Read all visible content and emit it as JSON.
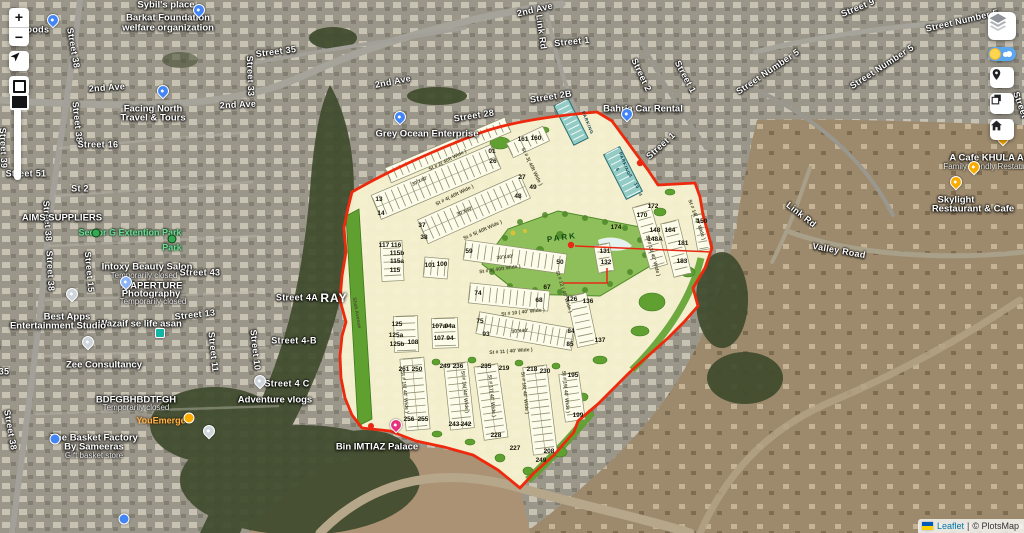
{
  "attribution": {
    "link": "Leaflet",
    "rest": "© PlotsMap",
    "separator": "|"
  },
  "controls": {
    "zoom_in": "+",
    "zoom_out": "−",
    "left": [
      "zoom-in",
      "zoom-out",
      "locate",
      "draw-rectangle",
      "zoom-slider"
    ],
    "right": [
      "layers",
      "day-night-toggle",
      "marker",
      "copy-layers",
      "home"
    ]
  },
  "colors": {
    "plan_fill": "#f6f2d0",
    "plan_boundary": "#ee2a0e",
    "plan_green": "#5fa030",
    "commercial_teal": "#93ccc5",
    "toggle_blue": "#5aa7f0",
    "pin_blue": "#4285F4",
    "pin_orange": "#f9ab00",
    "pin_magenta": "#e5327f",
    "link_blue": "#0078A8"
  },
  "map_labels": [
    {
      "t": "Foods",
      "x": 35,
      "y": 30
    },
    {
      "t": "Sybil's place",
      "x": 166,
      "y": 5,
      "c": "poi"
    },
    {
      "t": "Barkat Foundation",
      "x": 168,
      "y": 18,
      "c": "poi"
    },
    {
      "t": "welfare organization",
      "x": 168,
      "y": 28,
      "c": "poi"
    },
    {
      "t": "2nd Ave",
      "x": 107,
      "y": 88,
      "r": -4
    },
    {
      "t": "2nd Ave",
      "x": 238,
      "y": 105,
      "r": -3
    },
    {
      "t": "2nd Ave",
      "x": 393,
      "y": 82,
      "r": -11
    },
    {
      "t": "2nd Ave",
      "x": 535,
      "y": 10,
      "r": -13
    },
    {
      "t": "Street 38",
      "x": 73,
      "y": 48,
      "r": 80
    },
    {
      "t": "Street 38",
      "x": 77,
      "y": 122,
      "r": 84
    },
    {
      "t": "Street 38",
      "x": 47,
      "y": 221,
      "r": 86
    },
    {
      "t": "Street 38",
      "x": 50,
      "y": 271,
      "r": 87
    },
    {
      "t": "Street 38",
      "x": 10,
      "y": 430,
      "r": 80
    },
    {
      "t": "Street 39",
      "x": 3,
      "y": 148,
      "r": 88
    },
    {
      "t": "Street 35",
      "x": 276,
      "y": 52,
      "r": -7
    },
    {
      "t": "Street 33",
      "x": 250,
      "y": 76,
      "r": 88
    },
    {
      "t": "Street 16",
      "x": 98,
      "y": 145
    },
    {
      "t": "Street 51",
      "x": 26,
      "y": 174
    },
    {
      "t": "St 2",
      "x": 80,
      "y": 189
    },
    {
      "t": "Facing North",
      "x": 153,
      "y": 109,
      "c": "poi"
    },
    {
      "t": "Travel & Tours",
      "x": 153,
      "y": 118,
      "c": "poi"
    },
    {
      "t": "AIMS SUPPLIERS",
      "x": 62,
      "y": 218,
      "c": "poi"
    },
    {
      "t": "Sector G Extention Park",
      "x": 130,
      "y": 233,
      "c": "grn"
    },
    {
      "t": "Park",
      "x": 172,
      "y": 248,
      "c": "grn"
    },
    {
      "t": "Intoxy Beauty Salon",
      "x": 147,
      "y": 267,
      "c": "poi"
    },
    {
      "t": "Temporarily closed",
      "x": 144,
      "y": 276,
      "c": "sub"
    },
    {
      "t": "Street 43",
      "x": 200,
      "y": 273
    },
    {
      "t": "X APERTURE",
      "x": 152,
      "y": 286,
      "c": "poi"
    },
    {
      "t": "Photography",
      "x": 151,
      "y": 294,
      "c": "poi"
    },
    {
      "t": "Temporarily closed",
      "x": 153,
      "y": 302,
      "c": "sub"
    },
    {
      "t": "Street 13",
      "x": 195,
      "y": 315,
      "r": -6
    },
    {
      "t": "Street 15",
      "x": 89,
      "y": 272,
      "r": 85
    },
    {
      "t": "Wazaif se life asan",
      "x": 140,
      "y": 324,
      "c": "poi"
    },
    {
      "t": "Best Apps",
      "x": 67,
      "y": 317,
      "c": "poi"
    },
    {
      "t": "Entertainment Studio",
      "x": 58,
      "y": 326,
      "c": "poi"
    },
    {
      "t": "Street 36",
      "x": -6,
      "y": 330,
      "r": 84
    },
    {
      "t": "35",
      "x": 4,
      "y": 372
    },
    {
      "t": "Zee Consultancy",
      "x": 104,
      "y": 365,
      "c": "poi"
    },
    {
      "t": "BDFGBHBDTFGH",
      "x": 136,
      "y": 400,
      "c": "poi"
    },
    {
      "t": "Temporarily closed",
      "x": 136,
      "y": 408,
      "c": "sub"
    },
    {
      "t": "YouEmerge",
      "x": 161,
      "y": 421,
      "c": "org"
    },
    {
      "t": "The Basket Factory",
      "x": 94,
      "y": 438,
      "c": "poi"
    },
    {
      "t": "By Sameeras",
      "x": 94,
      "y": 447,
      "c": "poi"
    },
    {
      "t": "Gift basket store",
      "x": 94,
      "y": 456,
      "c": "sub"
    },
    {
      "t": "Adventure vlogs",
      "x": 275,
      "y": 400,
      "c": "poi"
    },
    {
      "t": "Street 4 C",
      "x": 287,
      "y": 384
    },
    {
      "t": "Street 4A",
      "x": 297,
      "y": 298
    },
    {
      "t": "Street 4-B",
      "x": 294,
      "y": 341
    },
    {
      "t": "Street 10",
      "x": 255,
      "y": 350,
      "r": 84
    },
    {
      "t": "Street 11",
      "x": 213,
      "y": 352,
      "r": 84
    },
    {
      "t": "RAY",
      "x": 334,
      "y": 298,
      "c": "big"
    },
    {
      "t": "Bin IMTIAZ Palace",
      "x": 377,
      "y": 447,
      "c": "poi"
    },
    {
      "t": "Grey Ocean Enterprise",
      "x": 427,
      "y": 134,
      "c": "poi"
    },
    {
      "t": "Street 28",
      "x": 474,
      "y": 116,
      "r": -9
    },
    {
      "t": "Street 2B",
      "x": 551,
      "y": 97,
      "r": -9
    },
    {
      "t": "Street 1",
      "x": 572,
      "y": 42,
      "r": -6
    },
    {
      "t": "Link Rd",
      "x": 541,
      "y": 32,
      "r": 82
    },
    {
      "t": "Street 2",
      "x": 641,
      "y": 75,
      "r": 65
    },
    {
      "t": "Street 1",
      "x": 685,
      "y": 77,
      "r": 62
    },
    {
      "t": "Street 1",
      "x": 661,
      "y": 146,
      "r": -42
    },
    {
      "t": "Bahria Car Rental",
      "x": 643,
      "y": 109,
      "c": "poi"
    },
    {
      "t": "Street 9",
      "x": 858,
      "y": 8,
      "r": -22
    },
    {
      "t": "Street Number 5",
      "x": 962,
      "y": 21,
      "r": -13
    },
    {
      "t": "Street Number 5",
      "x": 882,
      "y": 67,
      "r": -33
    },
    {
      "t": "Street Number 5",
      "x": 768,
      "y": 72,
      "r": -34
    },
    {
      "t": "Street",
      "x": 1020,
      "y": 105,
      "r": 70
    },
    {
      "t": "Link Rd",
      "x": 801,
      "y": 215,
      "r": 38
    },
    {
      "t": "Valley Road",
      "x": 839,
      "y": 251,
      "r": 10
    },
    {
      "t": "A Cafe KHULA AA",
      "x": 990,
      "y": 158,
      "c": "poi"
    },
    {
      "t": "Family-friendly Restaurant",
      "x": 990,
      "y": 167,
      "c": "sub"
    },
    {
      "t": "Skylight",
      "x": 956,
      "y": 200,
      "c": "poi"
    },
    {
      "t": "Restaurant & Cafe",
      "x": 973,
      "y": 209,
      "c": "poi"
    }
  ],
  "overlay": {
    "texts": [
      {
        "t": "St # 2( 40ft Wide )",
        "x": 448,
        "y": 161,
        "r": -27
      },
      {
        "t": "St # 4( 40ft Wide )",
        "x": 455,
        "y": 196,
        "r": -26
      },
      {
        "t": "St # 5( 40ft Wide )",
        "x": 483,
        "y": 231,
        "r": -24
      },
      {
        "t": "St # 9( 40ft Wide )",
        "x": 500,
        "y": 270,
        "r": -8
      },
      {
        "t": "St # 3( 40ft Wide )",
        "x": 531,
        "y": 167,
        "r": 64
      },
      {
        "t": "St # 10 ( 40' Wide )",
        "x": 523,
        "y": 313,
        "r": -6
      },
      {
        "t": "St # 11 ( 40' Wide )",
        "x": 511,
        "y": 352,
        "r": -4
      },
      {
        "t": "St # 12 ( 40' Wide )",
        "x": 563,
        "y": 292,
        "r": 72
      },
      {
        "t": "St # 13( 40' Wide )",
        "x": 652,
        "y": 256,
        "r": 74
      },
      {
        "t": "St # 14( 40' Wide )",
        "x": 696,
        "y": 220,
        "r": 70
      },
      {
        "t": "St # 15( 40' Wide )",
        "x": 404,
        "y": 392,
        "r": 84
      },
      {
        "t": "St # 16( 40' Wide )",
        "x": 464,
        "y": 392,
        "r": 84
      },
      {
        "t": "St # 17( 40' Wide )",
        "x": 491,
        "y": 396,
        "r": 84
      },
      {
        "t": "St # 18( 40' Wide )",
        "x": 524,
        "y": 393,
        "r": 84
      },
      {
        "t": "St # 19( 40' Wide )",
        "x": 565,
        "y": 392,
        "r": 84
      },
      {
        "t": "Shah Avenue",
        "x": 356,
        "y": 313,
        "r": 80
      },
      {
        "t": "30'X40'",
        "x": 420,
        "y": 182,
        "r": -25
      },
      {
        "t": "30'X40'",
        "x": 465,
        "y": 212,
        "r": -24
      },
      {
        "t": "30'X40'",
        "x": 505,
        "y": 258,
        "r": -6
      },
      {
        "t": "30'X40'",
        "x": 520,
        "y": 332,
        "r": -5
      },
      {
        "t": "PARK",
        "x": 562,
        "y": 238,
        "r": -8,
        "c": "park"
      },
      {
        "t": "PARKING",
        "x": 587,
        "y": 123,
        "r": 68,
        "c": "pkg"
      },
      {
        "t": "PARKING",
        "x": 624,
        "y": 164,
        "r": 68,
        "c": "pkg"
      },
      {
        "t": "10",
        "x": 636,
        "y": 186,
        "r": 65,
        "c": "pkg"
      },
      {
        "t": "8",
        "x": 630,
        "y": 176,
        "r": 65,
        "c": "pkg"
      },
      {
        "t": "5",
        "x": 617,
        "y": 170,
        "r": 65,
        "c": "pkg"
      },
      {
        "t": "4",
        "x": 640,
        "y": 195,
        "r": 65,
        "c": "pkg"
      }
    ],
    "plot_numbers": [
      {
        "t": "01",
        "x": 492,
        "y": 152
      },
      {
        "t": "26",
        "x": 493,
        "y": 162
      },
      {
        "t": "13",
        "x": 379,
        "y": 200
      },
      {
        "t": "14",
        "x": 381,
        "y": 214
      },
      {
        "t": "37",
        "x": 422,
        "y": 226
      },
      {
        "t": "38",
        "x": 424,
        "y": 238
      },
      {
        "t": "27",
        "x": 522,
        "y": 178
      },
      {
        "t": "49",
        "x": 533,
        "y": 188
      },
      {
        "t": "48",
        "x": 518,
        "y": 197
      },
      {
        "t": "161",
        "x": 523,
        "y": 140
      },
      {
        "t": "160",
        "x": 536,
        "y": 139
      },
      {
        "t": "150",
        "x": 702,
        "y": 222
      },
      {
        "t": "117",
        "x": 384,
        "y": 246
      },
      {
        "t": "116",
        "x": 396,
        "y": 246
      },
      {
        "t": "115b",
        "x": 397,
        "y": 254
      },
      {
        "t": "115a",
        "x": 397,
        "y": 262
      },
      {
        "t": "115",
        "x": 395,
        "y": 271
      },
      {
        "t": "101",
        "x": 430,
        "y": 266
      },
      {
        "t": "100",
        "x": 442,
        "y": 265
      },
      {
        "t": "59",
        "x": 469,
        "y": 252
      },
      {
        "t": "50",
        "x": 560,
        "y": 263
      },
      {
        "t": "172",
        "x": 653,
        "y": 207
      },
      {
        "t": "170",
        "x": 642,
        "y": 216
      },
      {
        "t": "174",
        "x": 616,
        "y": 228
      },
      {
        "t": "148",
        "x": 655,
        "y": 231
      },
      {
        "t": "164",
        "x": 670,
        "y": 231
      },
      {
        "t": "148A",
        "x": 655,
        "y": 240
      },
      {
        "t": "181",
        "x": 683,
        "y": 244
      },
      {
        "t": "183",
        "x": 682,
        "y": 262
      },
      {
        "t": "131",
        "x": 605,
        "y": 252
      },
      {
        "t": "132",
        "x": 606,
        "y": 263
      },
      {
        "t": "74",
        "x": 478,
        "y": 294
      },
      {
        "t": "67",
        "x": 547,
        "y": 288
      },
      {
        "t": "68",
        "x": 539,
        "y": 301
      },
      {
        "t": "126",
        "x": 572,
        "y": 300
      },
      {
        "t": "136",
        "x": 588,
        "y": 302
      },
      {
        "t": "125",
        "x": 397,
        "y": 325
      },
      {
        "t": "125a",
        "x": 396,
        "y": 336
      },
      {
        "t": "125b",
        "x": 397,
        "y": 345
      },
      {
        "t": "108",
        "x": 413,
        "y": 343
      },
      {
        "t": "107a",
        "x": 439,
        "y": 327
      },
      {
        "t": "94a",
        "x": 450,
        "y": 327
      },
      {
        "t": "107",
        "x": 439,
        "y": 339
      },
      {
        "t": "94",
        "x": 450,
        "y": 339
      },
      {
        "t": "75",
        "x": 480,
        "y": 322
      },
      {
        "t": "93",
        "x": 486,
        "y": 335
      },
      {
        "t": "84",
        "x": 571,
        "y": 332
      },
      {
        "t": "85",
        "x": 570,
        "y": 345
      },
      {
        "t": "137",
        "x": 600,
        "y": 341
      },
      {
        "t": "261",
        "x": 404,
        "y": 370
      },
      {
        "t": "250",
        "x": 417,
        "y": 370
      },
      {
        "t": "249",
        "x": 445,
        "y": 367
      },
      {
        "t": "236",
        "x": 458,
        "y": 367
      },
      {
        "t": "235",
        "x": 486,
        "y": 367
      },
      {
        "t": "219",
        "x": 504,
        "y": 369
      },
      {
        "t": "218",
        "x": 532,
        "y": 370
      },
      {
        "t": "230",
        "x": 545,
        "y": 372
      },
      {
        "t": "195",
        "x": 573,
        "y": 376
      },
      {
        "t": "256",
        "x": 409,
        "y": 420
      },
      {
        "t": "255",
        "x": 423,
        "y": 420
      },
      {
        "t": "243",
        "x": 454,
        "y": 425
      },
      {
        "t": "242",
        "x": 466,
        "y": 425
      },
      {
        "t": "228",
        "x": 496,
        "y": 436
      },
      {
        "t": "227",
        "x": 515,
        "y": 449
      },
      {
        "t": "208",
        "x": 549,
        "y": 452
      },
      {
        "t": "249",
        "x": 541,
        "y": 461
      },
      {
        "t": "199",
        "x": 578,
        "y": 416
      }
    ]
  },
  "pins": [
    {
      "x": 53,
      "y": 26,
      "col": "#4285F4",
      "s": "drop",
      "n": "place-pin"
    },
    {
      "x": 199,
      "y": 16,
      "col": "#4285F4",
      "s": "drop",
      "n": "place-pin"
    },
    {
      "x": 163,
      "y": 97,
      "col": "#4285F4",
      "s": "drop",
      "n": "place-pin"
    },
    {
      "x": 400,
      "y": 123,
      "col": "#4285F4",
      "s": "drop",
      "n": "place-pin"
    },
    {
      "x": 627,
      "y": 120,
      "col": "#4285F4",
      "s": "drop",
      "n": "place-pin"
    },
    {
      "x": 55,
      "y": 439,
      "col": "#4285F4",
      "s": "dot",
      "n": "place-dot-pin"
    },
    {
      "x": 124,
      "y": 519,
      "col": "#4285F4",
      "s": "dot",
      "n": "place-dot-pin"
    },
    {
      "x": 126,
      "y": 288,
      "col": "#8ab4f8",
      "s": "drop",
      "n": "shop-pin"
    },
    {
      "x": 72,
      "y": 300,
      "col": "#cdd5db",
      "s": "drop",
      "n": "shop-pin"
    },
    {
      "x": 88,
      "y": 348,
      "col": "#cdd5db",
      "s": "drop",
      "n": "shop-pin"
    },
    {
      "x": 260,
      "y": 387,
      "col": "#cdd5db",
      "s": "drop",
      "n": "shop-pin"
    },
    {
      "x": 209,
      "y": 437,
      "col": "#cdd5db",
      "s": "drop",
      "n": "shop-pin"
    },
    {
      "x": 160,
      "y": 333,
      "col": "#12b5a5",
      "s": "sq",
      "n": "service-pin"
    },
    {
      "x": 189,
      "y": 418,
      "col": "#f9ab00",
      "s": "dot",
      "n": "business-pin"
    },
    {
      "x": 1003,
      "y": 144,
      "col": "#f9ab00",
      "s": "drop",
      "n": "cafe-pin"
    },
    {
      "x": 974,
      "y": 173,
      "col": "#f9ab00",
      "s": "drop",
      "n": "restaurant-pin"
    },
    {
      "x": 956,
      "y": 188,
      "col": "#f9ab00",
      "s": "drop",
      "n": "cafe-pin"
    },
    {
      "x": 396,
      "y": 431,
      "col": "#e5327f",
      "s": "drop",
      "n": "venue-pin"
    },
    {
      "x": 96,
      "y": 233,
      "col": "#34a853",
      "s": "tree",
      "n": "park-icon"
    },
    {
      "x": 172,
      "y": 239,
      "col": "#34a853",
      "s": "tree",
      "n": "park-icon"
    }
  ]
}
